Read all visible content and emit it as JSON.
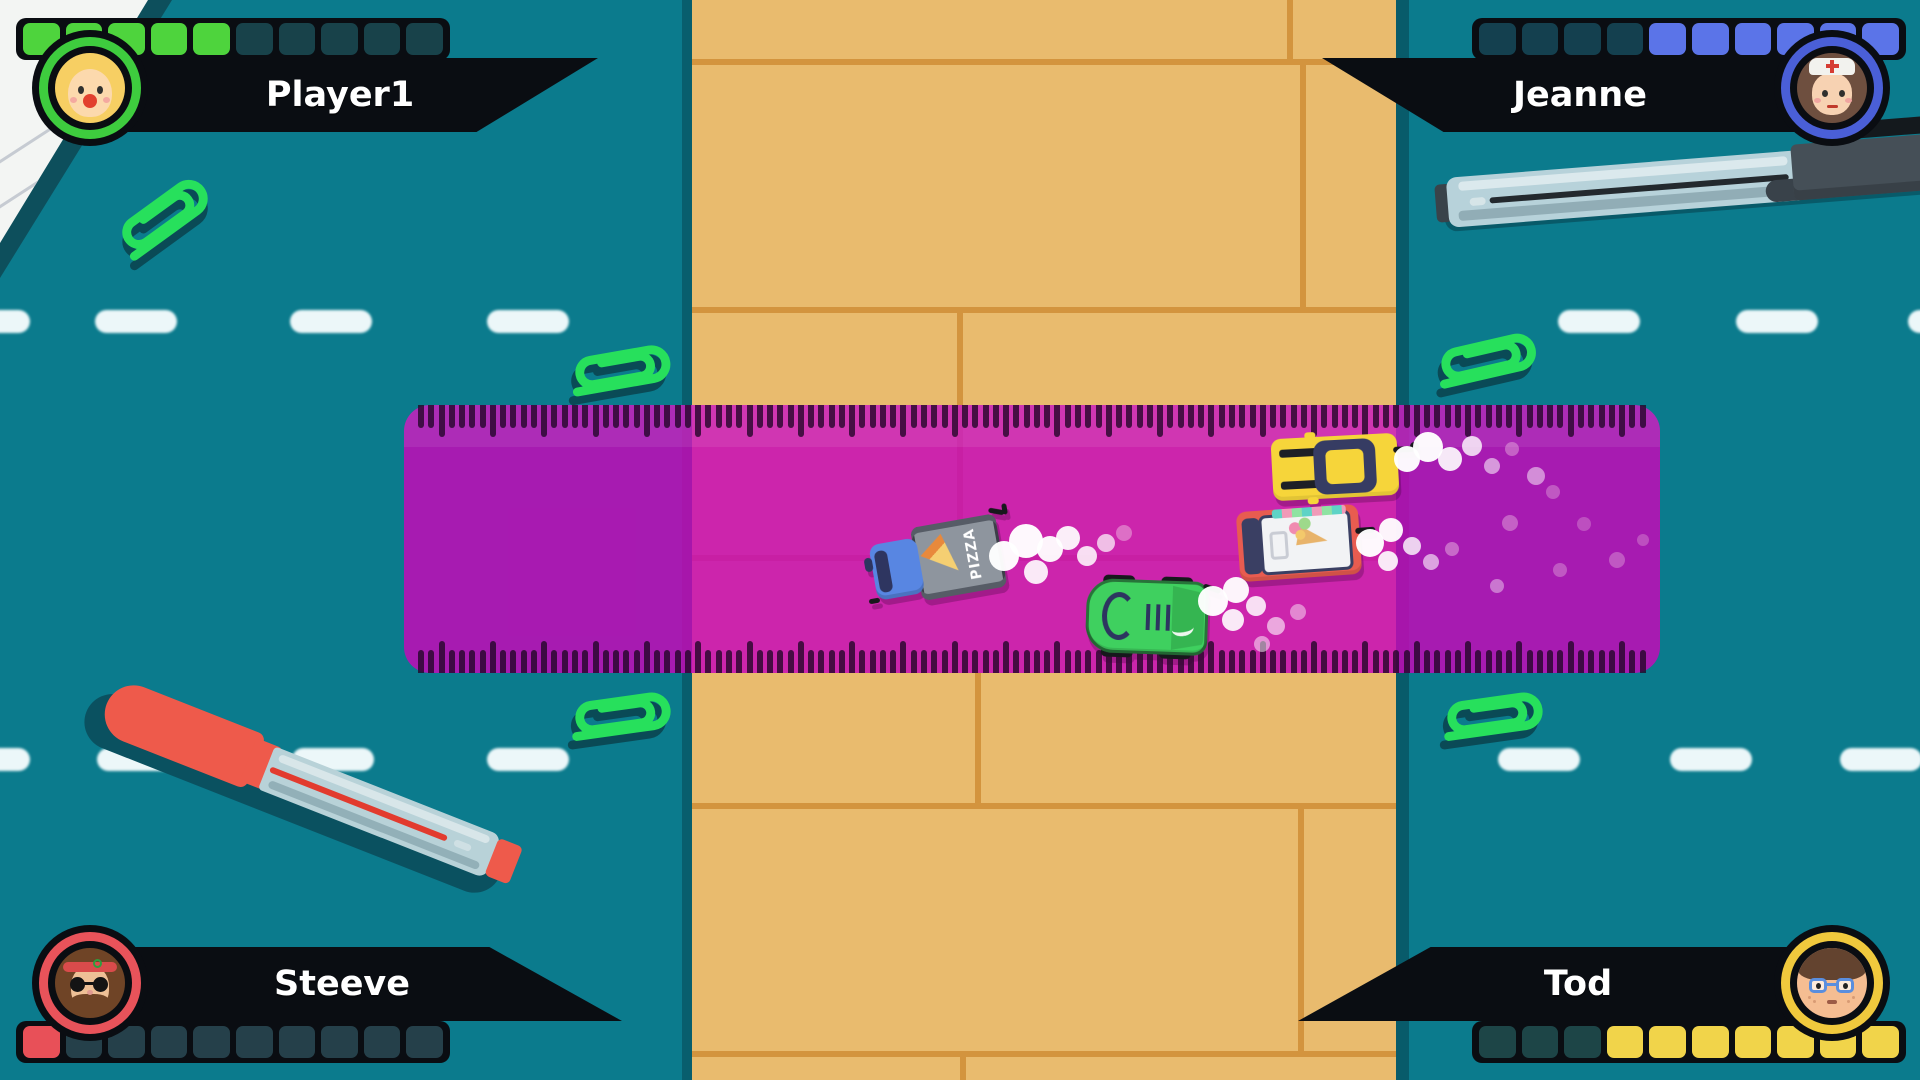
{
  "hud": {
    "players": [
      {
        "name": "Player1",
        "corner": "top-left",
        "health": {
          "filled": 5,
          "total": 10
        },
        "fill_color": "#4ed43d",
        "empty_color": "#18424a",
        "ring_color": "#3ecc3e",
        "avatar": "blonde-girl"
      },
      {
        "name": "Jeanne",
        "corner": "top-right",
        "health": {
          "filled": 6,
          "total": 10
        },
        "fill_color": "#5b74e8",
        "empty_color": "#14404f",
        "ring_color": "#4a5fd7",
        "avatar": "nurse"
      },
      {
        "name": "Steeve",
        "corner": "bottom-left",
        "health": {
          "filled": 1,
          "total": 10
        },
        "fill_color": "#e85058",
        "empty_color": "#25404a",
        "ring_color": "#e8535a",
        "avatar": "hippie"
      },
      {
        "name": "Tod",
        "corner": "bottom-right",
        "health": {
          "filled": 7,
          "total": 10
        },
        "fill_color": "#f1d44a",
        "empty_color": "#1d4547",
        "ring_color": "#f0c93d",
        "avatar": "kid-glasses"
      }
    ]
  },
  "scene": {
    "background_color": "#0b7b8d",
    "desk": {
      "wood_color": "#e9bb6e",
      "seam_color": "#d3943e"
    },
    "ruler": {
      "color": "rgba(198,8,184,0.84)",
      "tick_color": "rgba(35,6,40,0.8)"
    },
    "paperclip_color": "#27e05c",
    "paperclip_shadow_color": "#0a4a56",
    "chalk_color": "#ecf7f9",
    "smoke_white": "#ffffff",
    "smoke_pink": "#f2cae6",
    "vehicles": [
      {
        "type": "taxi",
        "body_color": "#f6d53a"
      },
      {
        "type": "ice-cream-van",
        "body_color": "#e85c50"
      },
      {
        "type": "pizza-truck",
        "body_color": "#8e959e",
        "cab_color": "#5886e2",
        "label": "PIZZA"
      },
      {
        "type": "sports-car",
        "body_color": "#3fd05f"
      }
    ]
  }
}
